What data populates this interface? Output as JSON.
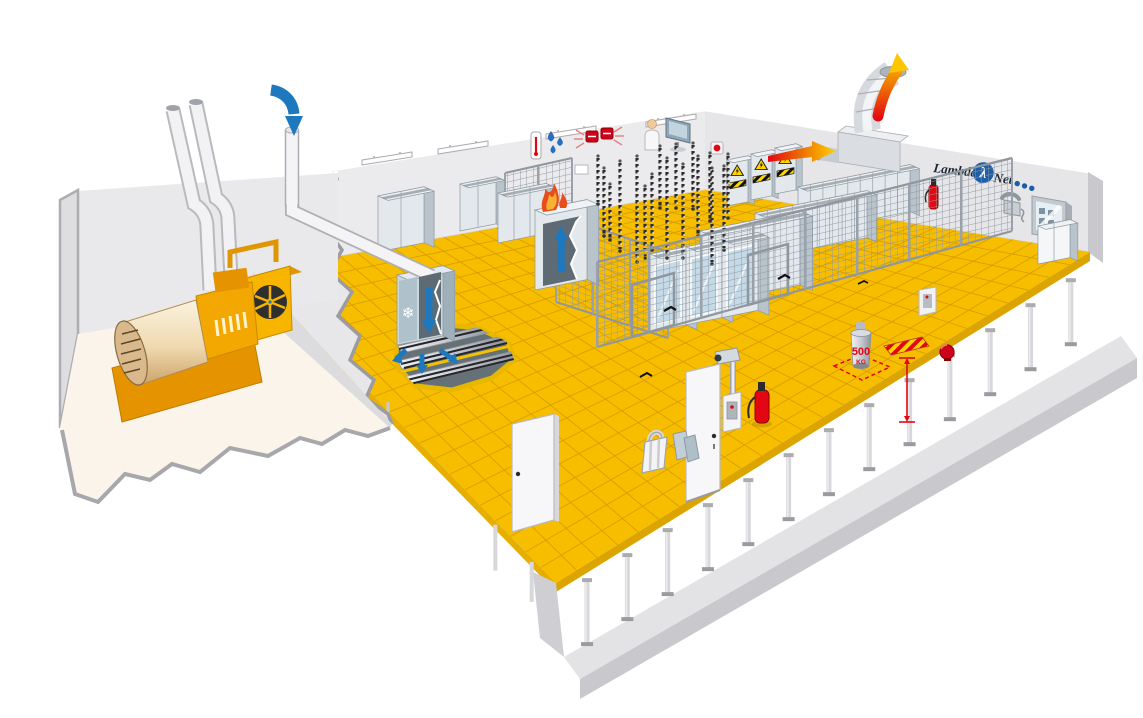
{
  "scene": {
    "type": "isometric-datacenter-cutaway-illustration",
    "background": "#FFFFFF"
  },
  "logo": {
    "word_left": "Lambda",
    "word_right": "Net",
    "lambda_symbol": "λ",
    "dot_count": 3,
    "text_color": "#1A2433",
    "accent_color": "#1C5FA8"
  },
  "floor_load_sign": {
    "value": "500",
    "unit": "KG",
    "color": "#E30613"
  },
  "icons": {
    "snowflake": "❄",
    "warning_triangle": "high-voltage-warning",
    "thermometer": "temperature-sensor",
    "water_drops": "humidity-sensor",
    "alarm_strobe": "fire-alarm-strobe",
    "monitoring_station": "person-at-monitor",
    "telephone": "wall-phone",
    "fire_extinguisher": "fire-extinguisher",
    "fire_bell": "alarm-bell",
    "cctv_camera": "surveillance-camera",
    "intake_arrow": "cold-air-intake",
    "exhaust_arrow": "hot-air-exhaust"
  },
  "counts": {
    "ceiling_lights": 4,
    "electrical_panels": 3,
    "logo_dots": 3,
    "floor_pedestals": 13,
    "hanging_cable_chains": 17,
    "cage_doors": 2,
    "fire_extinguishers": 4
  },
  "colors": {
    "floor_yellow": "#F7BE00",
    "floor_grid": "#D79E00",
    "wall_left": "#EBEBED",
    "wall_right": "#E6E6E9",
    "slab_gray": "#C9C9CD",
    "generator_room_floor": "#FAF4EA",
    "generator_yellow": "#F5A800",
    "arrow_blue": "#1E78BE",
    "fire_red": "#E30613",
    "flame_yellow": "#FFD500",
    "cage_mesh": "#9199A3",
    "rack_front": "#E2E8EC",
    "rack_glass": "#C4DAE7"
  },
  "objects": [
    "diesel-generator",
    "exhaust-chimneys",
    "cold-air-intake-duct",
    "crac-cooling-unit",
    "under-floor-cable-trays",
    "server-rack-rows",
    "glass-door-racks",
    "security-mesh-cage",
    "hot-air-exhaust-duct",
    "raised-floor",
    "floor-load-weight-500kg",
    "tile-lifter",
    "access-card-readers",
    "cctv-camera",
    "fire-extinguishers",
    "fire-alarm-bell",
    "observation-window",
    "wall-telephone",
    "monitoring-station",
    "electrical-panels"
  ]
}
